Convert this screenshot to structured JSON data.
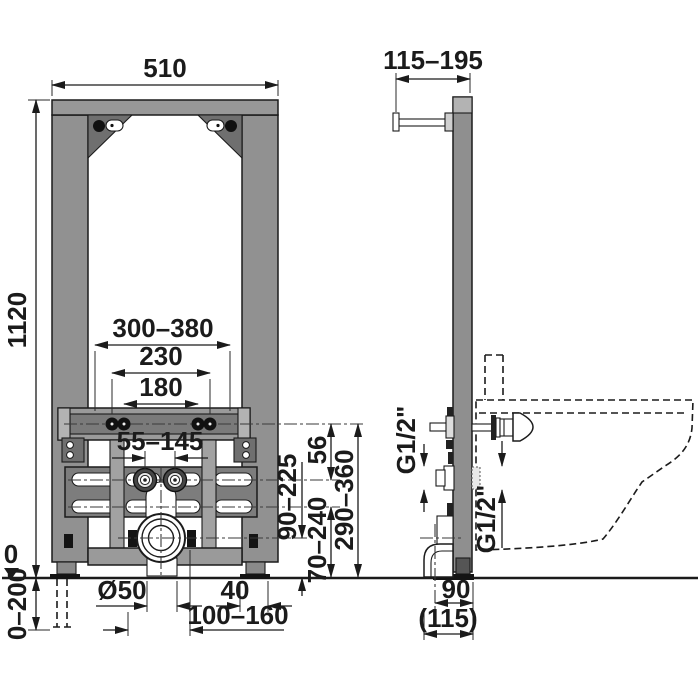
{
  "title": "bidet-installation-frame-technical-drawing",
  "colors": {
    "frame_gray": "#919191",
    "frame_dark": "#6f6f6f",
    "plate_gray": "#7d7d7d",
    "strap_gray": "#a2a2a2",
    "cap_gray": "#b3b3b3",
    "foot_black": "#141414",
    "line_black": "#1b1b1b",
    "background": "#ffffff"
  },
  "front": {
    "width": "510",
    "height": "1120",
    "stud_range": "300–380",
    "stud_outer": "230",
    "stud_inner": "180",
    "water_span": "55–145",
    "slots_to_drain": "90–225",
    "rail_to_slots": "56",
    "slots_to_floor": "70–240",
    "studs_to_floor": "290–360",
    "zero": "0",
    "foot_adjust": "0–200",
    "drain_dia": "Ø50",
    "foot_width": "40",
    "drain_range": "100–160"
  },
  "side": {
    "depth_range": "115–195",
    "conn_upper": "G1/2\"",
    "conn_lower": "G1/2\"",
    "drain_axis": "90",
    "depth_total": "(115)"
  }
}
